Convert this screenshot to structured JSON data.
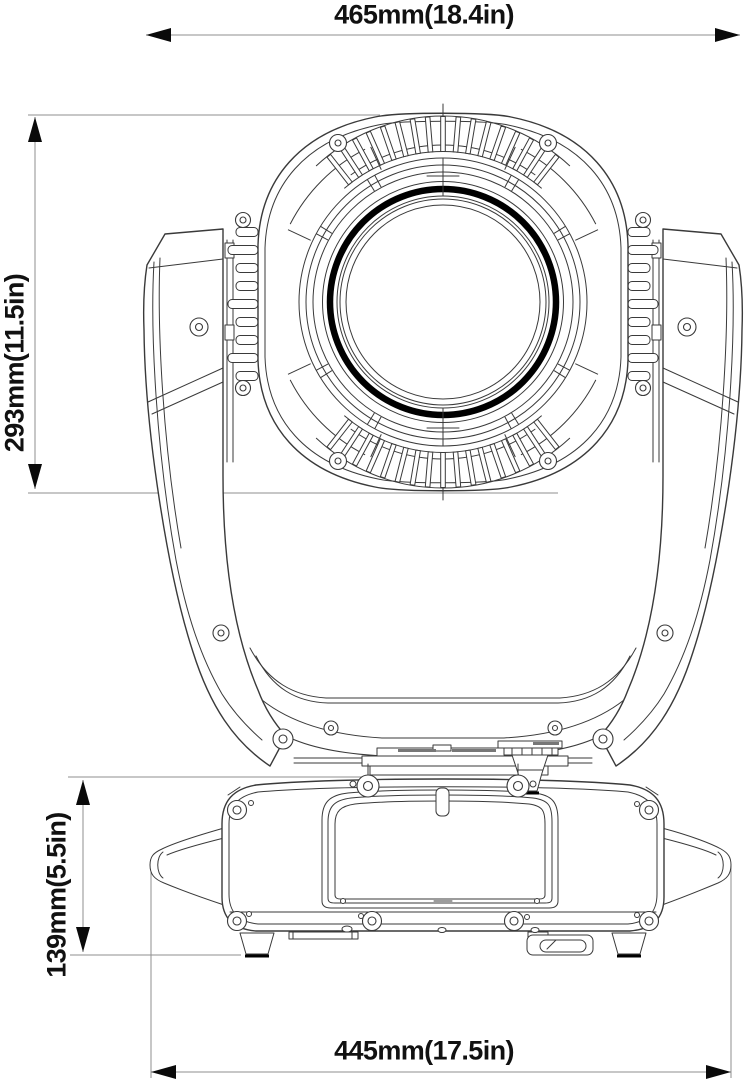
{
  "page": {
    "title": "Moving head light fixture dimensional drawing",
    "background": "#ffffff"
  },
  "dimensions": {
    "overall_width": {
      "label": "465mm(18.4in)",
      "orientation": "horizontal",
      "position": "top"
    },
    "head_height": {
      "label": "293mm(11.5in)",
      "orientation": "vertical",
      "position": "left"
    },
    "base_height": {
      "label": "139mm(5.5in)",
      "orientation": "vertical",
      "position": "lower-left"
    },
    "base_width": {
      "label": "445mm(17.5in)",
      "orientation": "horizontal",
      "position": "bottom"
    }
  },
  "colors": {
    "line": "#3a3a3a",
    "dimension": "#8f8f8f",
    "ink": "#111111",
    "lens_ring": "#000000",
    "background": "#ffffff"
  }
}
